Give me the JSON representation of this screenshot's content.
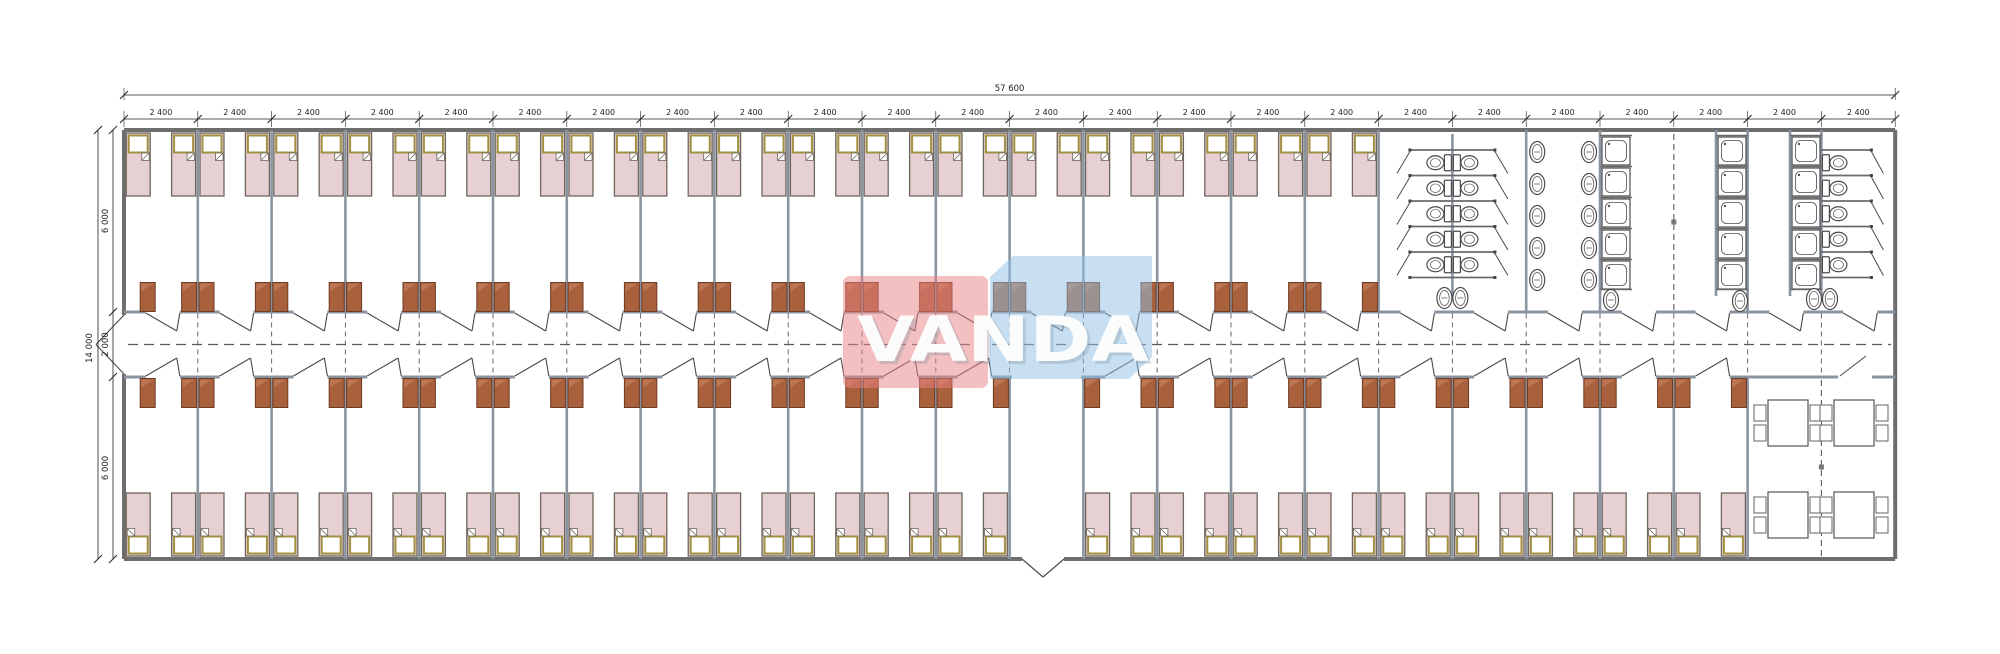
{
  "watermark": {
    "text": "VANDA",
    "red_color": "#e97f82",
    "blue_color": "#8fc0e4",
    "text_color": "#ffffff"
  },
  "dimensions": {
    "total_width": "57 600",
    "module": "2 400",
    "module_count": 24,
    "total_height": "14 000",
    "top_band": "6 000",
    "corridor": "2 000",
    "bottom_band": "6 000"
  },
  "layout": {
    "top_bedroom_modules": 17,
    "bottom_bedroom_modules": 22,
    "entrance_module": 13,
    "wc_stalls": 5,
    "washbasins_per_column": 5,
    "showers_per_column": 5,
    "dining_tables": 4,
    "chairs_per_table": 4
  },
  "colors": {
    "outer_wall": "#6e6e6e",
    "partition": "#8a94a0",
    "thin_line": "#4a4a4a",
    "bed_fill": "#e6d0d4",
    "bed_stroke": "#6f665c",
    "pillow_stroke": "#a29140",
    "wardrobe_fill": "#a9603d",
    "wardrobe_stroke": "#6f3b22",
    "wardrobe_highlight": "#c4835f",
    "fixture_stroke": "#4b4b4b",
    "dash": "#5a5a5a",
    "dim": "#222222"
  }
}
